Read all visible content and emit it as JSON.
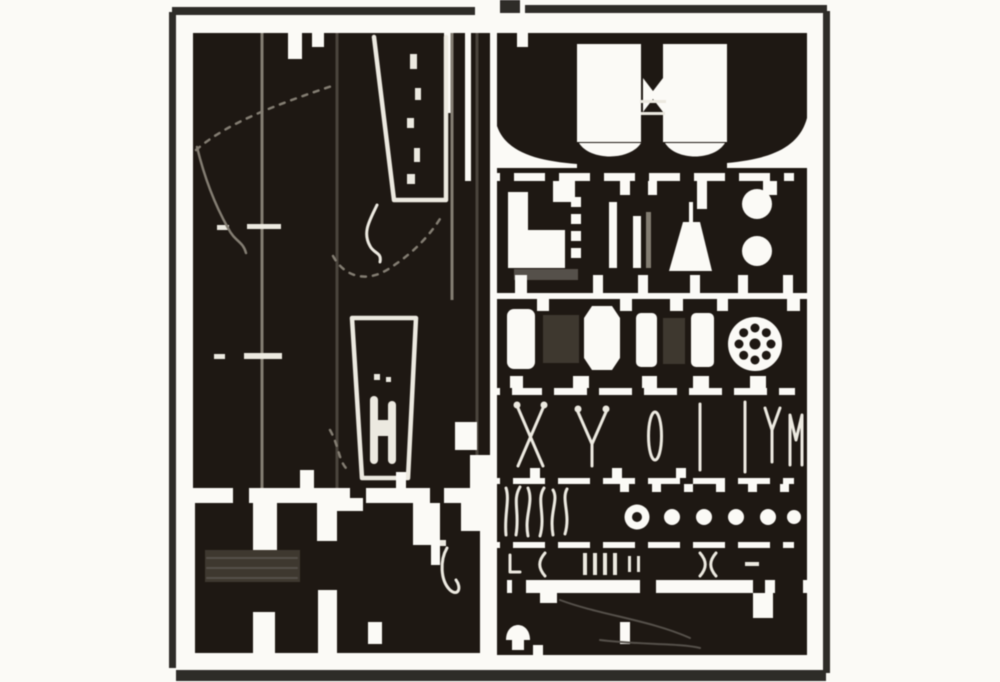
{
  "image": {
    "kind": "photo-etch-fret-photograph",
    "panel_count": 2
  },
  "colors": {
    "background": "#fbfaf6",
    "fret_dark": "#1e1813",
    "frame_line": "#2e2c28",
    "etch_light": "#ece9e0",
    "etch_gray": "#837d72",
    "half_etch": "#3e382f",
    "half_etch_soft": "#55504a"
  },
  "parts": {
    "frame": "sheet-border-frame",
    "left_panel": "large-plate-panel",
    "left_trapezoid_top": "trapezoid-plate-part",
    "left_trapezoid_bottom": "trapezoid-plate-part",
    "left_bottom_blocks": "rectangular-strip-parts",
    "right_row_a": "fender-parts-row",
    "right_row_b": "stowage-box-and-discs-row",
    "right_row_c": "plates-and-wheel-hub-row",
    "right_row_d": "tool-parts-row",
    "right_row_e": "ring-and-rivet-dots-row",
    "right_row_f": "small-clamp-parts-row",
    "right_row_g": "long-strip-part-row"
  }
}
